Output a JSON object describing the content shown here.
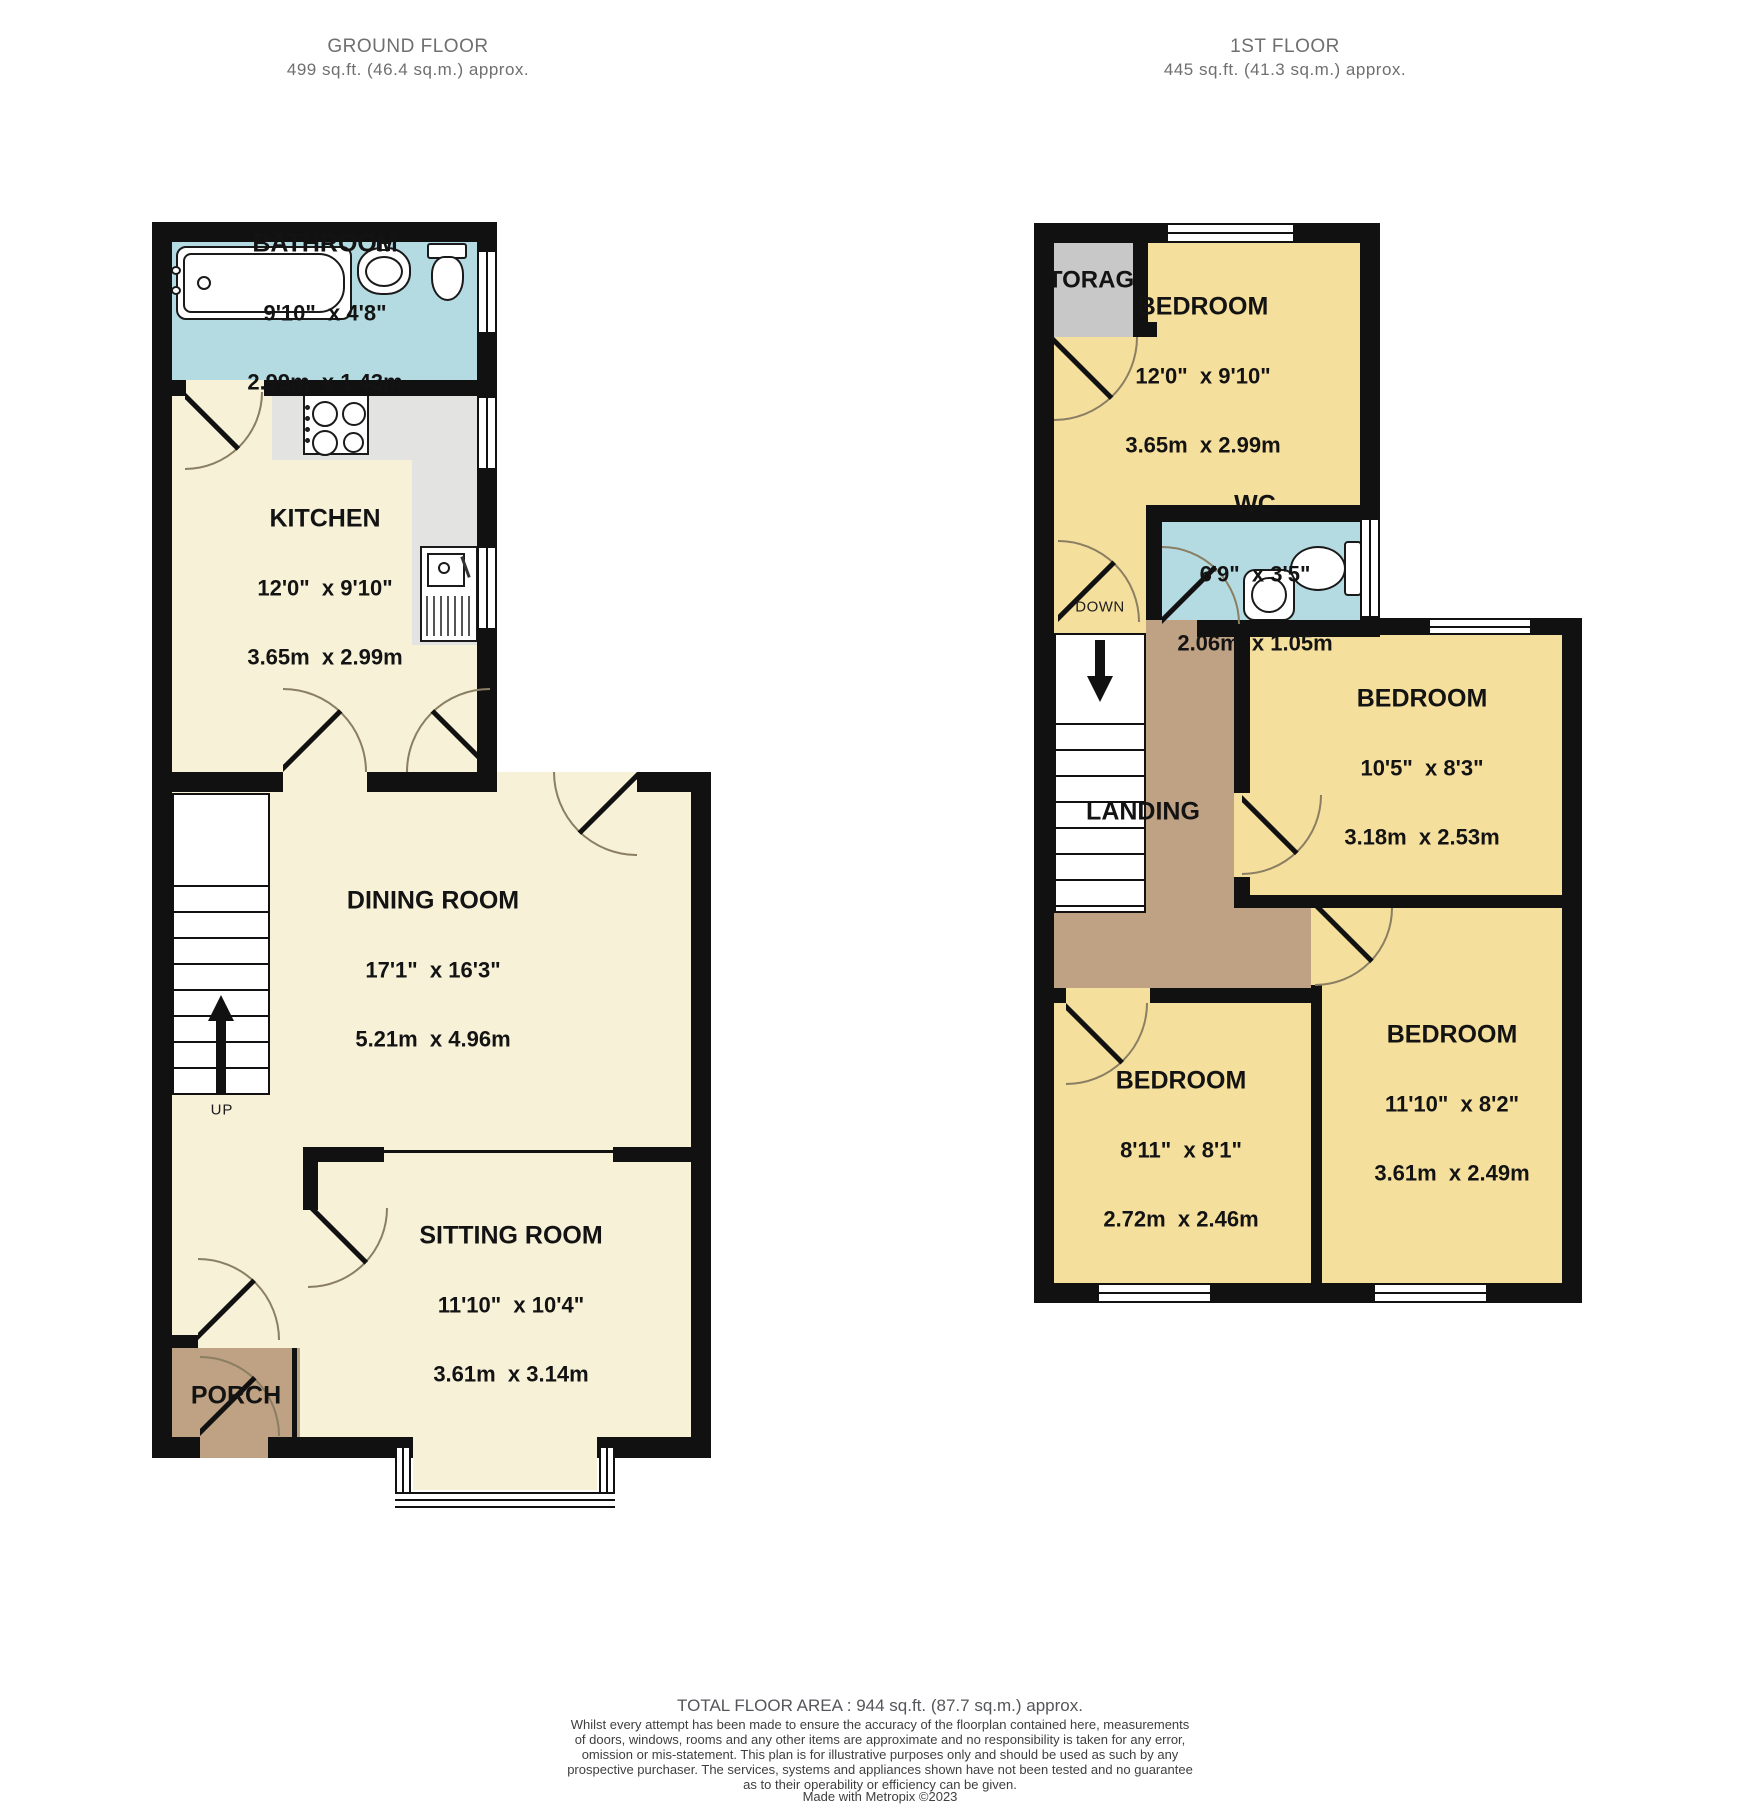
{
  "colors": {
    "wall": "#111111",
    "cream": "#f7f1d8",
    "yellow": "#f5df9c",
    "blue": "#b4dbe2",
    "brown": "#bfa183",
    "storage_gray": "#c8c8c8",
    "counter_gray": "#e3e3e2",
    "arc": "#8a7e63",
    "header_text": "#6f6f70",
    "label_text": "#131313",
    "footer_text": "#55565a"
  },
  "ground_floor": {
    "title": "GROUND FLOOR",
    "subtitle": "499 sq.ft. (46.4 sq.m.) approx.",
    "rooms": {
      "bathroom": {
        "name": "BATHROOM",
        "imperial": "9'10\"  x 4'8\"",
        "metric": "2.99m  x 1.43m"
      },
      "kitchen": {
        "name": "KITCHEN",
        "imperial": "12'0\"  x 9'10\"",
        "metric": "3.65m  x 2.99m"
      },
      "dining_room": {
        "name": "DINING ROOM",
        "imperial": "17'1\"  x 16'3\"",
        "metric": "5.21m  x 4.96m"
      },
      "sitting_room": {
        "name": "SITTING ROOM",
        "imperial": "11'10\"  x 10'4\"",
        "metric": "3.61m  x 3.14m"
      },
      "porch": {
        "name": "PORCH"
      }
    },
    "stairs_label": "UP"
  },
  "first_floor": {
    "title": "1ST FLOOR",
    "subtitle": "445 sq.ft. (41.3 sq.m.) approx.",
    "rooms": {
      "storage": {
        "name": "TORAG"
      },
      "bedroom_front": {
        "name": "BEDROOM",
        "imperial": "12'0\"  x 9'10\"",
        "metric": "3.65m  x 2.99m"
      },
      "wc": {
        "name": "WC",
        "imperial": "6'9\"  x 3'5\"",
        "metric": "2.06m  x 1.05m"
      },
      "landing": {
        "name": "LANDING"
      },
      "bedroom_middle": {
        "name": "BEDROOM",
        "imperial": "10'5\"  x 8'3\"",
        "metric": "3.18m  x 2.53m"
      },
      "bedroom_back_left": {
        "name": "BEDROOM",
        "imperial": "8'11\"  x 8'1\"",
        "metric": "2.72m  x 2.46m"
      },
      "bedroom_back_right": {
        "name": "BEDROOM",
        "imperial": "11'10\"  x 8'2\"",
        "metric": "3.61m  x 2.49m"
      }
    },
    "stairs_label": "DOWN"
  },
  "footer": {
    "total": "TOTAL FLOOR AREA : 944 sq.ft. (87.7 sq.m.) approx.",
    "disclaimer_lines": [
      "Whilst every attempt has been made to ensure the accuracy of the floorplan contained here, measurements",
      "of doors, windows, rooms and any other items are approximate and no responsibility is taken for any error,",
      "omission or mis-statement. This plan is for illustrative purposes only and should be used as such by any",
      "prospective purchaser. The services, systems and appliances shown have not been tested and no guarantee",
      "as to their operability or efficiency can be given."
    ],
    "credit": "Made with Metropix ©2023"
  }
}
